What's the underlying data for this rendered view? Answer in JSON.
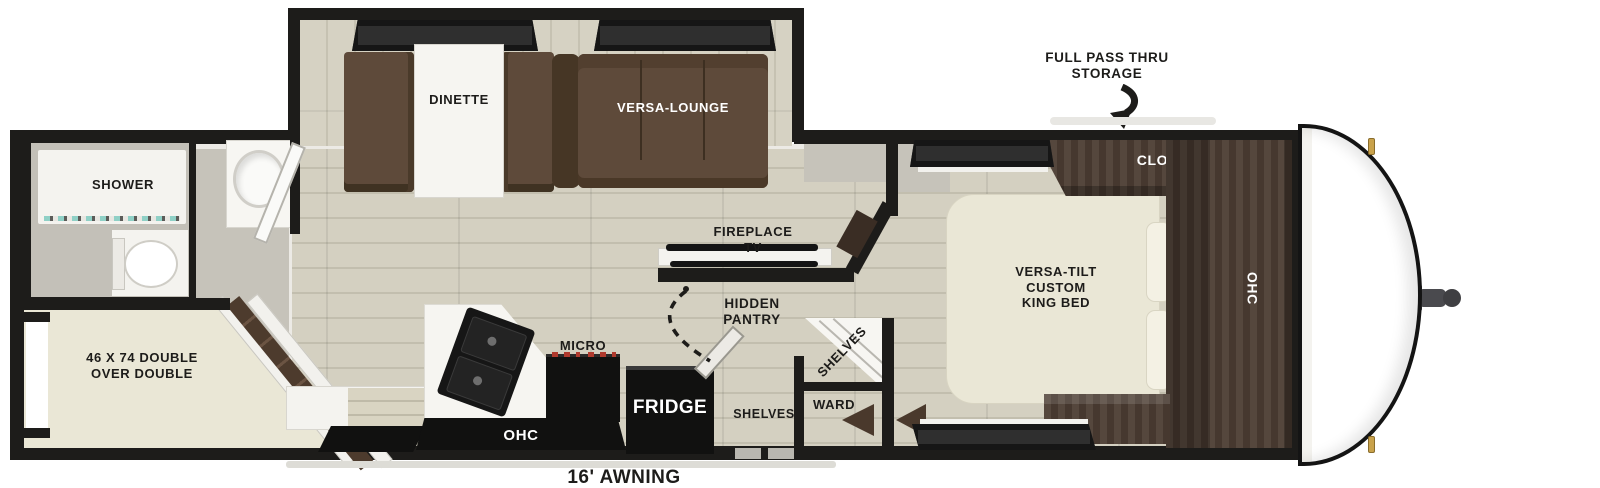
{
  "title": "Travel trailer floor plan",
  "callouts": {
    "storage": [
      "FULL PASS THRU",
      "STORAGE"
    ],
    "awning": "16' AWNING"
  },
  "rooms": {
    "bathroom": {
      "shower": "SHOWER"
    },
    "bunk_room": {
      "bed": [
        "46 X 74 DOUBLE",
        "OVER DOUBLE"
      ]
    },
    "living": {
      "dinette": "DINETTE",
      "lounge": "VERSA-LOUNGE",
      "fireplace": [
        "FIREPLACE",
        "TV"
      ],
      "pantry": [
        "HIDDEN",
        "PANTRY"
      ],
      "corner_shelves": "SHELVES"
    },
    "kitchen": {
      "micro": "MICRO",
      "fridge": "FRIDGE",
      "ohc": "OHC"
    },
    "hall": {
      "shelves": "SHELVES",
      "ward": "WARD"
    },
    "bedroom": {
      "bed": [
        "VERSA-TILT",
        "CUSTOM",
        "KING BED"
      ],
      "closet": "CLOSET",
      "ohc": "OHC"
    }
  },
  "colors": {
    "wall": "#1d1c1a",
    "floor": "#d4d0c1",
    "floor_line": "#c2beae",
    "sofa_brown": "#5e4a3a",
    "cabinet_walnut": "#4c3d33",
    "bed_cream": "#eae7d6",
    "interior_gray": "#c6c3ba",
    "burner_red": "#b03a2e",
    "latch_gold": "#c9a24b",
    "glass_teal": "#9adbd2"
  }
}
